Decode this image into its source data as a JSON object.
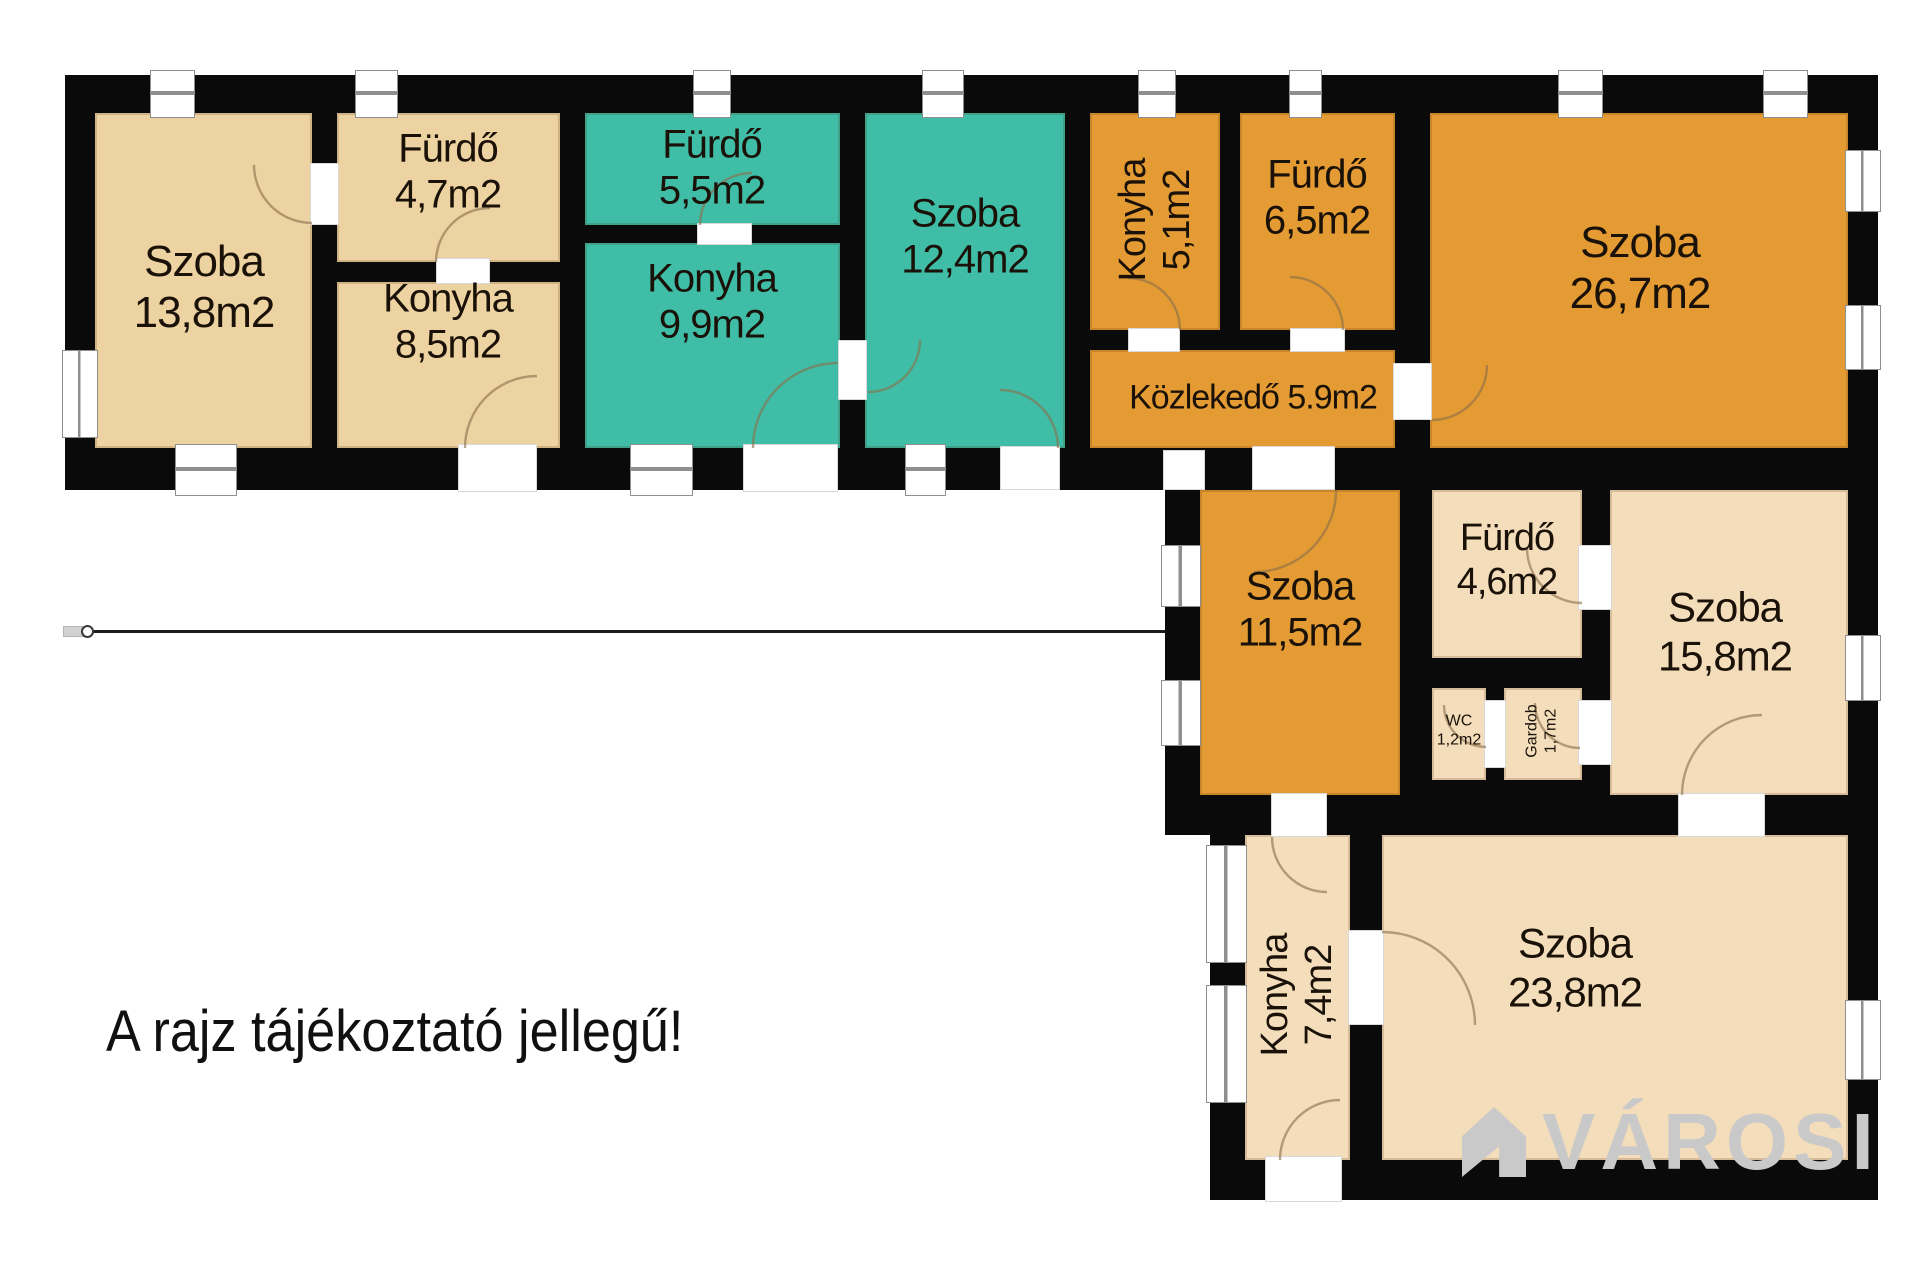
{
  "annotation": "A rajz tájékoztató jellegű!",
  "watermark": {
    "text": "VÁROSI"
  },
  "colors": {
    "wall": "#0a0a0a",
    "beige": "#eed3a2",
    "cream": "#f4ddbb",
    "teal": "#3fbda6",
    "orange": "#e49b33",
    "window_frame": "#8f8f8f",
    "door_arc": "#8a6f4a",
    "label_text": "#1a1208",
    "watermark": "#c9c9c9"
  },
  "rooms": [
    {
      "id": "szoba-13-8",
      "name": "Szoba",
      "area": "13,8m2"
    },
    {
      "id": "furdo-4-7",
      "name": "Fürdő",
      "area": "4,7m2"
    },
    {
      "id": "konyha-8-5",
      "name": "Konyha",
      "area": "8,5m2"
    },
    {
      "id": "furdo-5-5",
      "name": "Fürdő",
      "area": "5,5m2"
    },
    {
      "id": "konyha-9-9",
      "name": "Konyha",
      "area": "9,9m2"
    },
    {
      "id": "szoba-12-4",
      "name": "Szoba",
      "area": "12,4m2"
    },
    {
      "id": "konyha-5-1",
      "name": "Konyha",
      "area": "5,1m2"
    },
    {
      "id": "furdo-6-5",
      "name": "Fürdő",
      "area": "6,5m2"
    },
    {
      "id": "kozlekedo-5-9",
      "name": "Közlekedő",
      "area": "5.9m2"
    },
    {
      "id": "szoba-26-7",
      "name": "Szoba",
      "area": "26,7m2"
    },
    {
      "id": "szoba-11-5",
      "name": "Szoba",
      "area": "11,5m2"
    },
    {
      "id": "furdo-4-6",
      "name": "Fürdő",
      "area": "4,6m2"
    },
    {
      "id": "wc-1-2",
      "name": "WC",
      "area": "1,2m2"
    },
    {
      "id": "gardob-1-7",
      "name": "Gardob",
      "area": "1,7m2"
    },
    {
      "id": "szoba-15-8",
      "name": "Szoba",
      "area": "15,8m2"
    },
    {
      "id": "konyha-7-4",
      "name": "Konyha",
      "area": "7,4m2"
    },
    {
      "id": "szoba-23-8",
      "name": "Szoba",
      "area": "23,8m2"
    }
  ]
}
